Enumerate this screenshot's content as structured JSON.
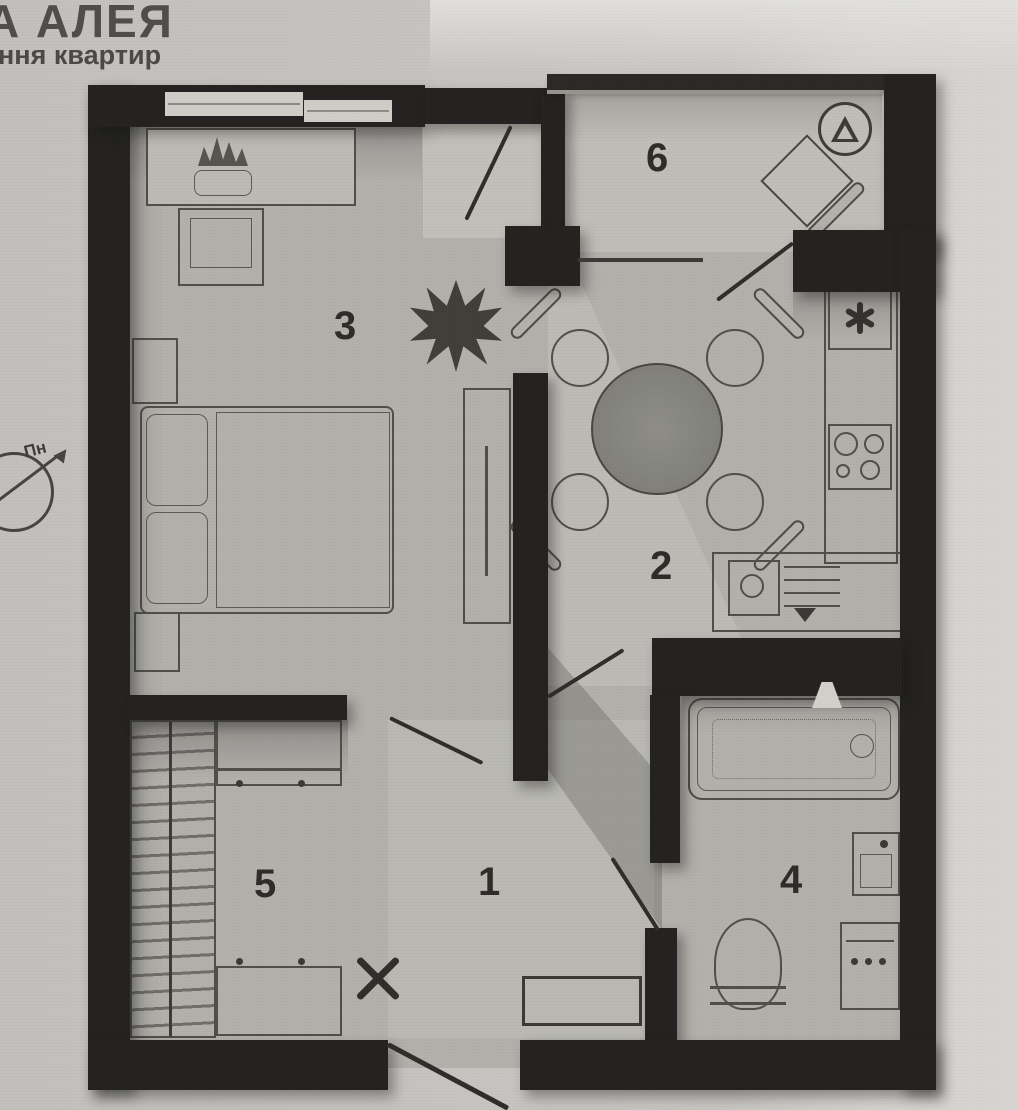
{
  "header": {
    "line1": "А АЛЕЯ",
    "line2": "ння квартир"
  },
  "compass": {
    "north_label": "Пн"
  },
  "plan": {
    "type": "apartment-floor-plan",
    "rooms": [
      {
        "number": "1"
      },
      {
        "number": "2"
      },
      {
        "number": "3"
      },
      {
        "number": "4"
      },
      {
        "number": "5"
      },
      {
        "number": "6"
      }
    ],
    "symbols": {
      "fridge": "six-spoke-asterisk",
      "balcony_badge": "triangle-in-circle",
      "hall_mark": "x-cross",
      "washer_dots": "three-dots"
    }
  }
}
